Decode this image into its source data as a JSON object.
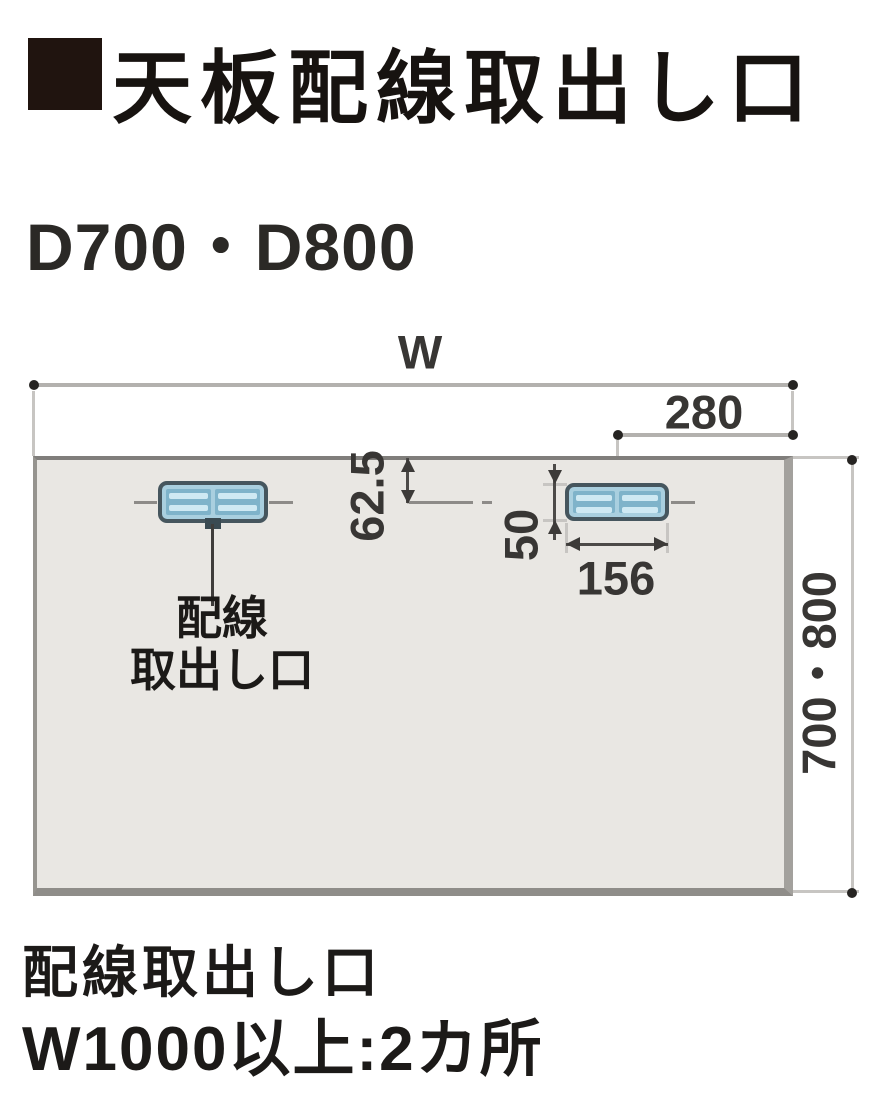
{
  "header": {
    "title": "天板配線取出し口"
  },
  "subtitle": "D700・D800",
  "diagram": {
    "width_label": "W",
    "dim_right_offset": "280",
    "dim_front_offset": "62.5",
    "dim_outlet_height": "50",
    "dim_outlet_width": "156",
    "dim_depth": "700・800",
    "outlet_callout_line1": "配線",
    "outlet_callout_line2": "取出し口",
    "outlet_count": 2
  },
  "footer": {
    "line1": "配線取出し口",
    "line2": "W1000以上:2カ所"
  },
  "colors": {
    "title_square": "#20140f",
    "desk_fill": "#e9e7e3",
    "desk_edge": "#8f8d89",
    "outlet_border": "#46565e",
    "outlet_fill": "#a9cfdf",
    "outlet_inner": "#7fb3ca",
    "dimension_line": "#b3b1ae",
    "text": "#1e1c1a"
  }
}
